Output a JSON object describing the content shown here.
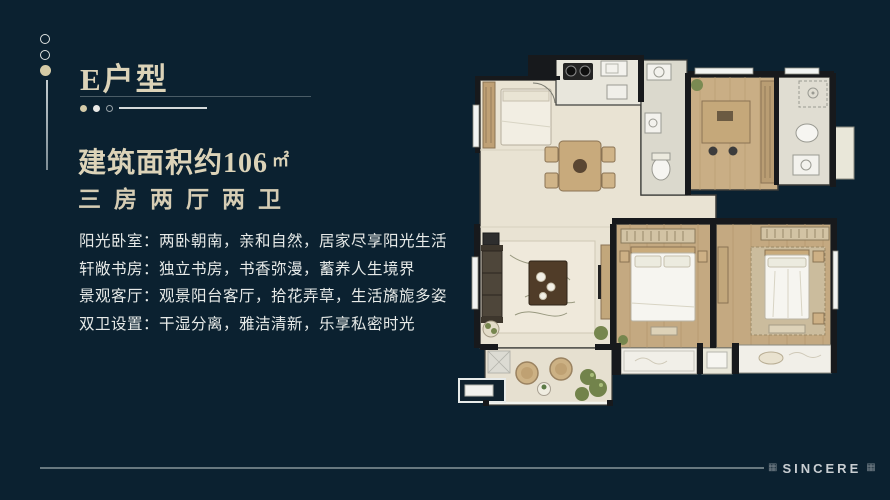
{
  "slide": {
    "title": "E户型",
    "area": {
      "label": "建筑面积约",
      "value": "106",
      "unit": "㎡"
    },
    "layout": "三房两厅两卫",
    "features": [
      "阳光卧室：两卧朝南，亲和自然，居家尽享阳光生活",
      "轩敞书房：独立书房，书香弥漫，蓄养人生境界",
      "景观客厅：观景阳台客厅，拾花弄草，生活旖旎多姿",
      "双卫设置：干湿分离，雅洁清新，乐享私密时光"
    ]
  },
  "footer": {
    "brand": "SINCERE",
    "left_glyph": "▦",
    "right_glyph": "▦"
  },
  "colors": {
    "background": "#0B2130",
    "accent_gold": "#D9D0B5",
    "body_text": "#E7EAE8",
    "divider": "#4A5C66",
    "footer_line": "#68787F",
    "brand_text": "#C9CED2",
    "plan_floor_cream": "#E9E3D3",
    "plan_floor_wood": "#C4A981",
    "plan_wall": "#17191C"
  }
}
